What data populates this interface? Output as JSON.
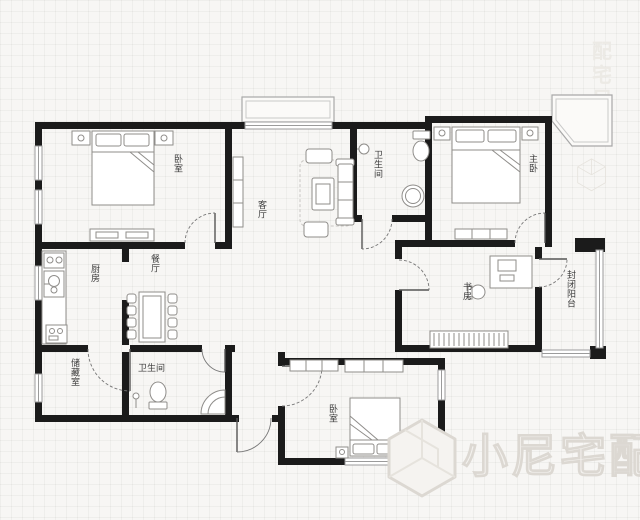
{
  "plan": {
    "rooms": {
      "bedroom_top_left": "卧室",
      "living_room": "客厅",
      "bathroom_main": "卫生间",
      "master_bedroom": "主卧",
      "study": "书房",
      "enclosed_balcony": "封闭阳台",
      "kitchen": "厨房",
      "dining_room": "餐厅",
      "storage": "储藏室",
      "bathroom_second": "卫生间",
      "bedroom_bottom": "卧室"
    },
    "watermark": {
      "brand_text": "小尼宅配",
      "vertical_text": "配宅尼小"
    },
    "colors": {
      "wall": "#1b1b1b",
      "background": "#f7f6f4",
      "watermark": "#f3f1ee"
    }
  }
}
